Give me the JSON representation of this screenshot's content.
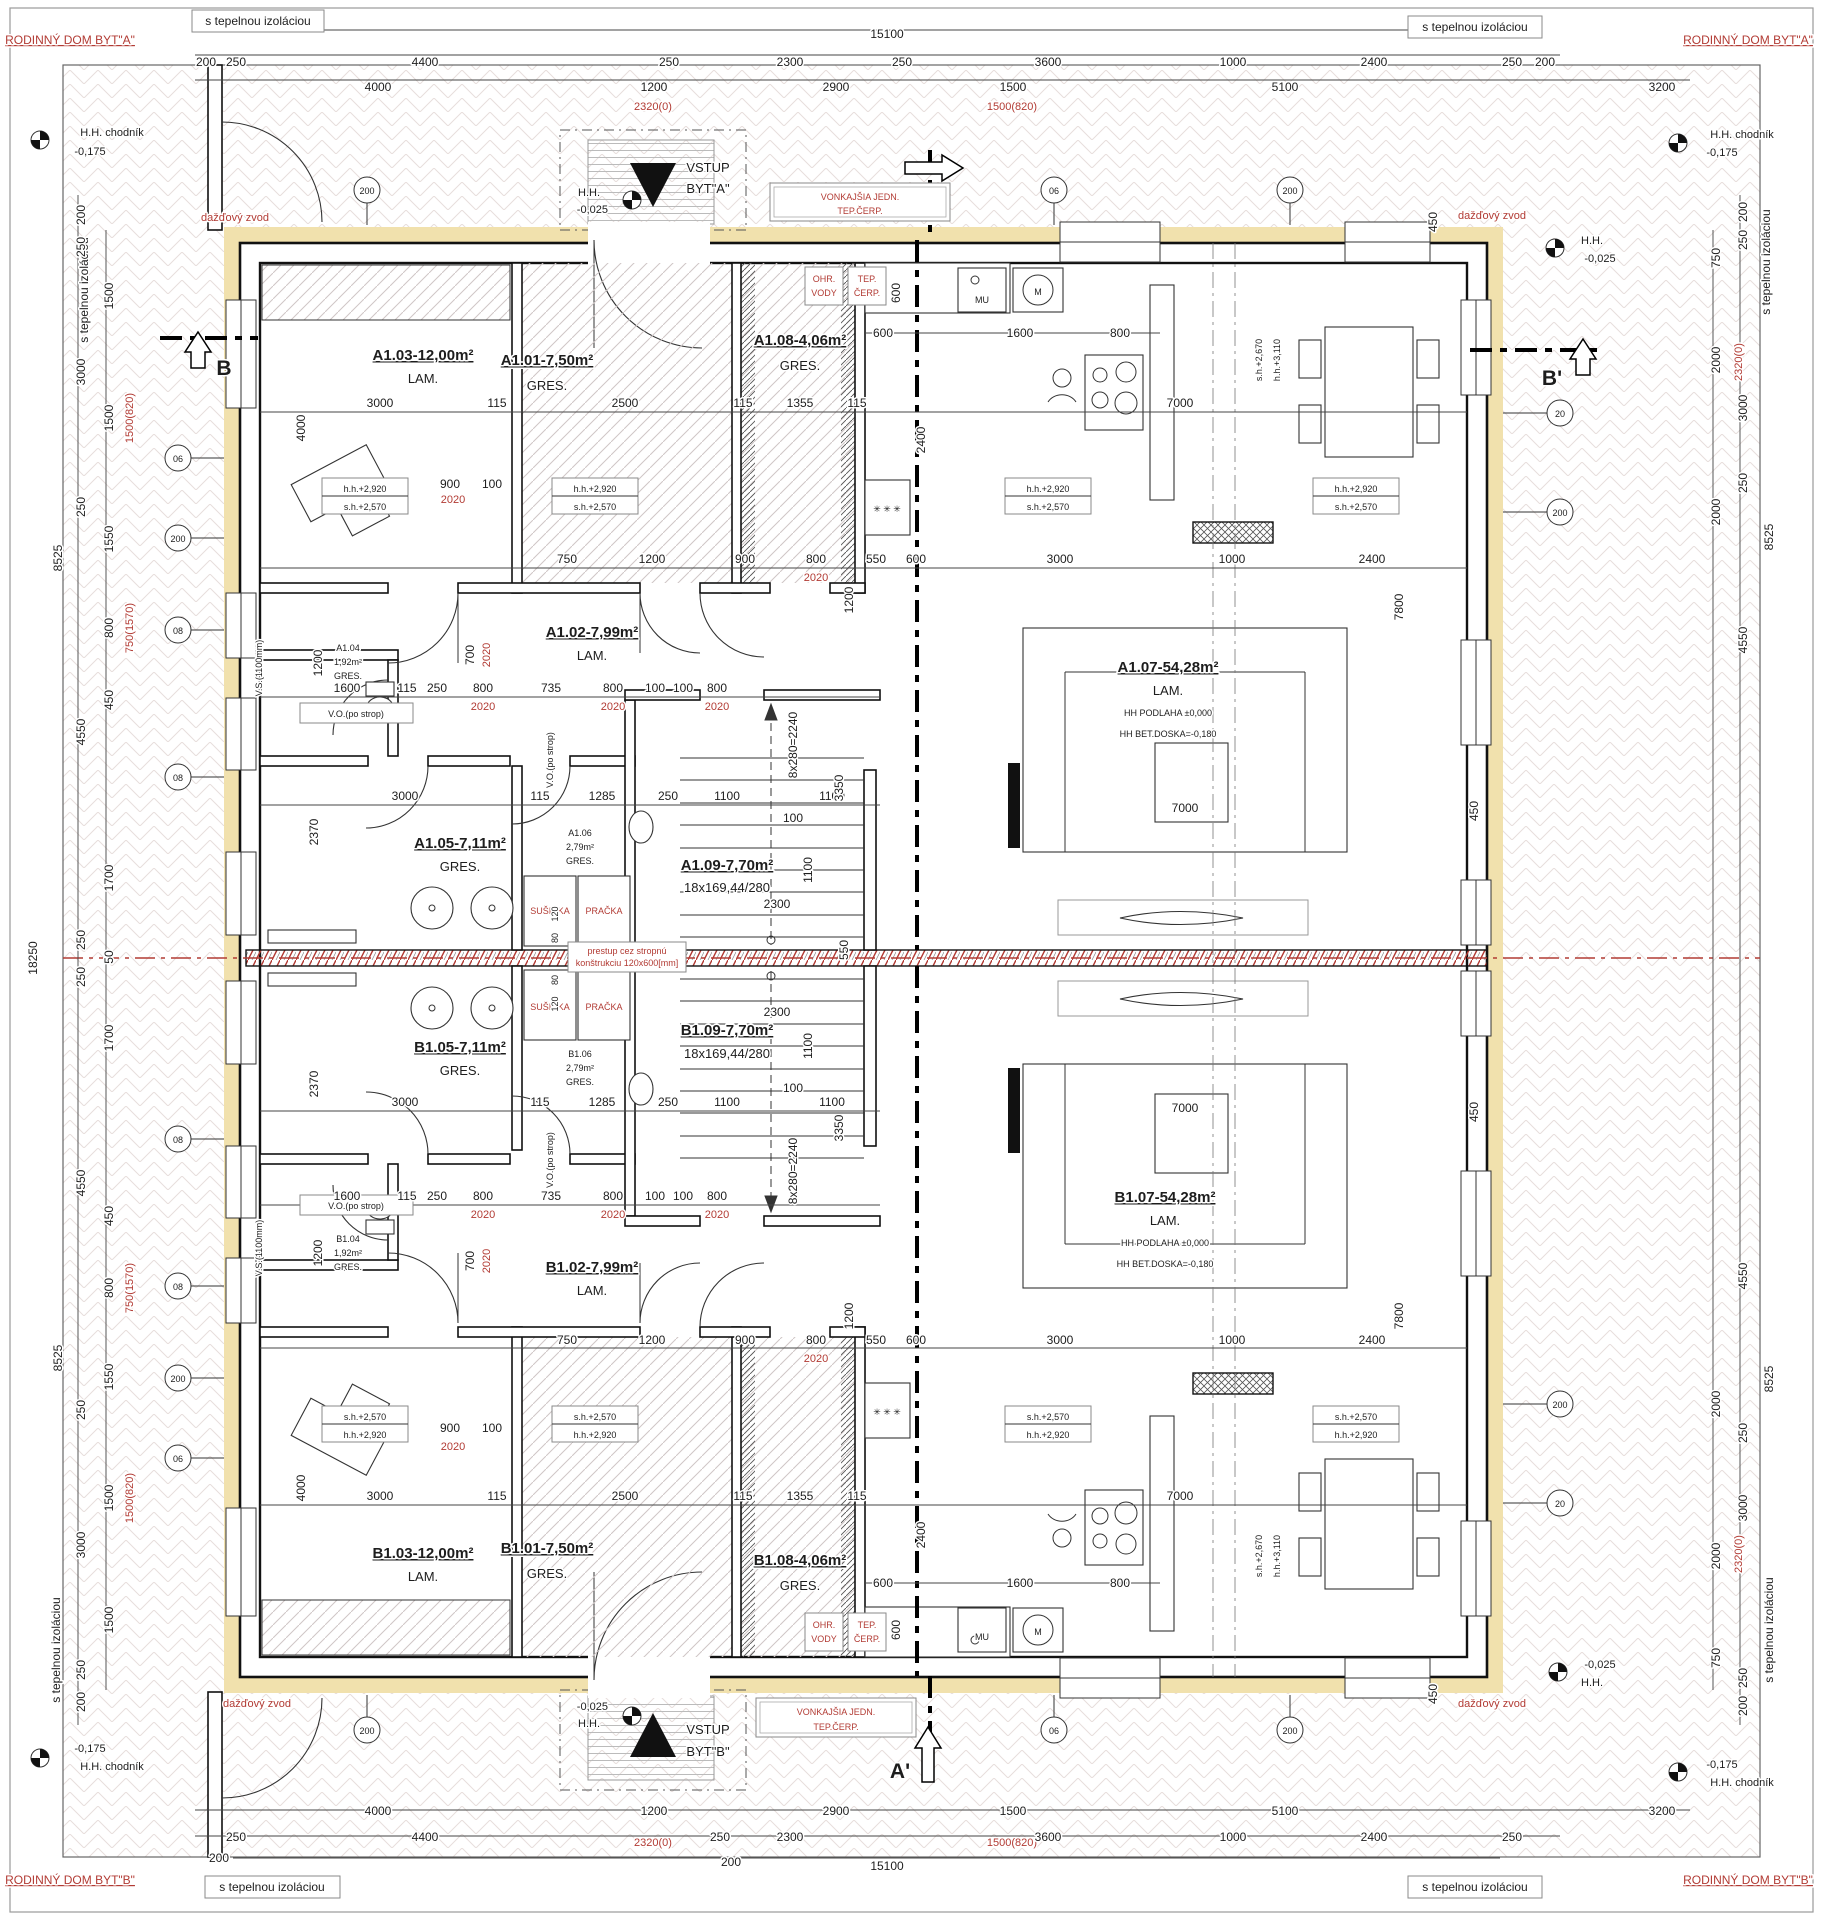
{
  "colors": {
    "red": "#b23b34",
    "yellow": "#f1e1ad",
    "wall": "#111111",
    "hatch": "#cfc6c6"
  },
  "titles": {
    "unit_a": "RODINNÝ DOM BYT\"A\"",
    "unit_b": "RODINNÝ DOM BYT\"B\""
  },
  "labels": {
    "insulation": "s tepelnou izoláciou",
    "downspout": "dažďový zvod",
    "sidewalk": "H.H. chodník",
    "sidewalk_level": "-0,175",
    "hh": "H.H.",
    "entry_level": "-0,025",
    "vstup": "VSTUP",
    "byt_a": "BYT\"A\"",
    "byt_b": "BYT\"B\"",
    "outdoor_unit_1": "VONKAJŠIA JEDN.",
    "outdoor_unit_2": "TEP.ČERP.",
    "ohr_1": "OHR.",
    "ohr_2": "VODY",
    "tc_1": "TEP.",
    "tc_2": "ČERP.",
    "susicka": "SUŠIČKA",
    "pracka": "PRAČKA",
    "mu": "MU",
    "m": "M",
    "vo": "V.O.(po strop)",
    "vs": "V.S.(1100mm)",
    "prestup_1": "prestup cez stropnú",
    "prestup_2": "konštrukciu 120x600[mm]",
    "hh_2920": "h.h.+2,920",
    "sh_2570": "s.h.+2,570",
    "sh_2670": "s.h.+2,670",
    "hh_3110": "h.h.+3,110",
    "podlaha": "HH PODLAHA ±0,000",
    "doska": "HH BET.DOSKA=-0,180",
    "stair_run": "18x169,44/280",
    "stair_rise": "8x280=2240",
    "stars": "✳ ✳ ✳"
  },
  "sections": {
    "a": "A",
    "a2": "A'",
    "b": "B",
    "b2": "B'"
  },
  "rooms": {
    "a103": "A1.03-12,00m²",
    "a101": "A1.01-7,50m²",
    "a108": "A1.08-4,06m²",
    "a102": "A1.02-7,99m²",
    "a104": "A1.04",
    "a104_area": "1,92m²",
    "a105": "A1.05-7,11m²",
    "a106": "A1.06",
    "a106_area": "2,79m²",
    "a107": "A1.07-54,28m²",
    "a109": "A1.09-7,70m²",
    "b103": "B1.03-12,00m²",
    "b101": "B1.01-7,50m²",
    "b108": "B1.08-4,06m²",
    "b102": "B1.02-7,99m²",
    "b104": "B1.04",
    "b105": "B1.05-7,11m²",
    "b106": "B1.06",
    "b107": "B1.07-54,28m²",
    "b109": "B1.09-7,70m²",
    "lam": "LAM.",
    "gres": "GRES."
  },
  "dims": {
    "d50": "50",
    "d80": "80",
    "d100": "100",
    "d115": "115",
    "d120": "120",
    "d200": "200",
    "d250": "250",
    "d450": "450",
    "d550": "550",
    "d600": "600",
    "d700": "700",
    "d735": "735",
    "d750": "750",
    "d800": "800",
    "d900": "900",
    "d1000": "1000",
    "d1100": "1100",
    "d1200": "1200",
    "d1285": "1285",
    "d1355": "1355",
    "d1500": "1500",
    "d1550": "1550",
    "d1600": "1600",
    "d1700": "1700",
    "d2000": "2000",
    "d2300": "2300",
    "d2370": "2370",
    "d2400": "2400",
    "d2500": "2500",
    "d2900": "2900",
    "d3000": "3000",
    "d3200": "3200",
    "d3350": "3350",
    "d3600": "3600",
    "d4000": "4000",
    "d4400": "4400",
    "d4550": "4550",
    "d5100": "5100",
    "d7000": "7000",
    "d7800": "7800",
    "d8525": "8525",
    "d15100": "15100",
    "d18250": "18250"
  },
  "red_dims": {
    "r2020": "2020",
    "r2320": "2320(0)",
    "r1500": "1500(820)",
    "r750": "750(1570)"
  },
  "marks": {
    "m06": "06",
    "m08": "08",
    "m20": "20",
    "m200": "200"
  }
}
